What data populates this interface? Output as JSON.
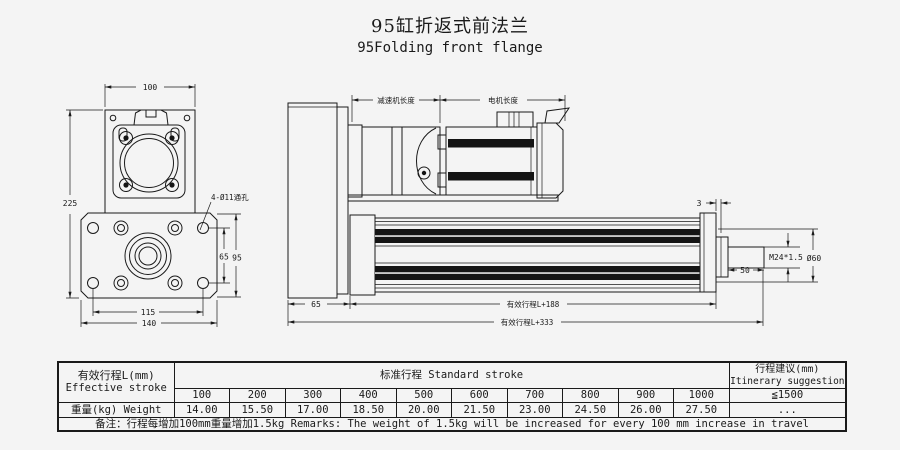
{
  "title": {
    "zh": "95缸折返式前法兰",
    "en": "95Folding front flange"
  },
  "colors": {
    "background": "#f4f4f4",
    "line": "#1a1a1a"
  },
  "drawing": {
    "front_view": {
      "dim_top_width": "100",
      "dim_total_height": "225",
      "dim_hole_span_v": "65",
      "dim_flange_v": "95",
      "dim_hole_span_h": "115",
      "dim_flange_width": "140",
      "hole_callout": "4-Ø11通孔"
    },
    "side_view": {
      "dim_reducer_len": "减速机长度",
      "dim_motor_len": "电机长度",
      "dim_plate_thk": "3",
      "dim_rod_thread": "M24*1.5",
      "dim_rod_dia": "Ø60",
      "dim_rod_len": "50",
      "dim_flange_thk": "65",
      "dim_body_len": "有效行程L+188",
      "dim_total_len": "有效行程L+333"
    }
  },
  "table": {
    "effective_stroke_zh": "有效行程L(mm)",
    "effective_stroke_en": "Effective stroke",
    "standard_stroke": "标准行程  Standard stroke",
    "suggestion_zh": "行程建议(mm)",
    "suggestion_en": "Itinerary suggestion",
    "suggestion_value": "≦1500",
    "strokes": [
      "100",
      "200",
      "300",
      "400",
      "500",
      "600",
      "700",
      "800",
      "900",
      "1000"
    ],
    "weight_label": "重量(kg) Weight",
    "weights": [
      "14.00",
      "15.50",
      "17.00",
      "18.50",
      "20.00",
      "21.50",
      "23.00",
      "24.50",
      "26.00",
      "27.50"
    ],
    "weight_extra": "...",
    "remarks": "备注：行程每增加100mm重量增加1.5kg    Remarks: The weight of 1.5kg will be increased for every 100 mm increase in travel"
  }
}
